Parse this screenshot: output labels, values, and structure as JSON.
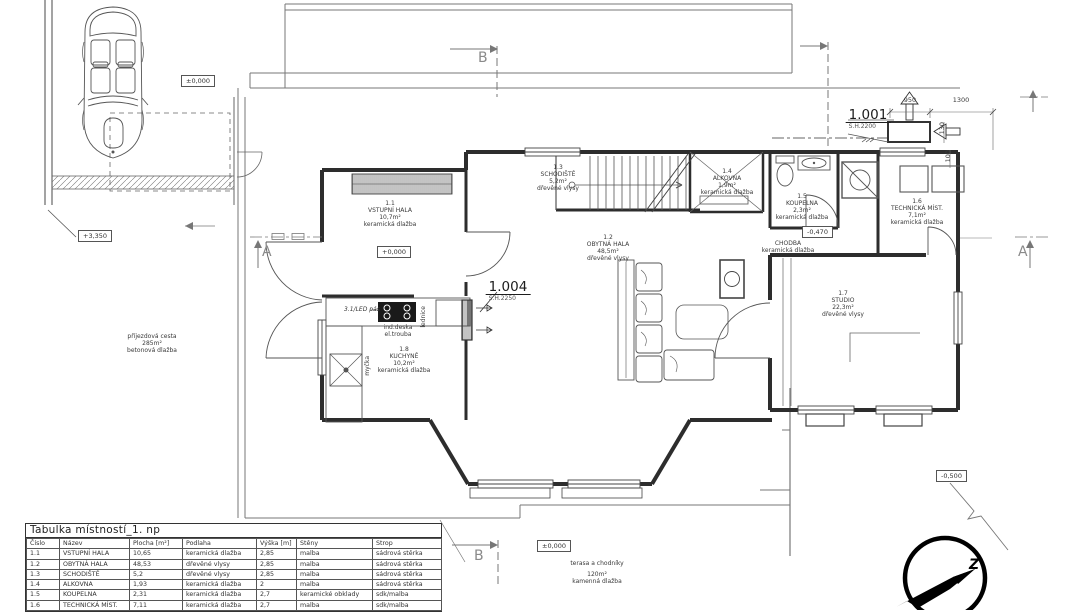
{
  "plan": {
    "levels": {
      "garage": "±0,000",
      "hall": "+0,000",
      "driveway_top": "+3,350",
      "chodba": "-0,470",
      "yard": "-0,500",
      "terrace": "±0,000"
    },
    "rooms": {
      "r11": {
        "num": "1.1",
        "name": "VSTUPNÍ HALA",
        "area": "10,7m²",
        "floor": "keramická dlažba"
      },
      "r12": {
        "num": "1.2",
        "name": "OBYTNÁ HALA",
        "area": "48,5m²",
        "floor": "dřevěné vlysy"
      },
      "r13": {
        "num": "1.3",
        "name": "SCHODIŠTĚ",
        "area": "5,2m²",
        "floor": "dřevěné vlysy"
      },
      "r14": {
        "num": "1.4",
        "name": "ALKOVNA",
        "area": "1,9m²",
        "floor": "keramická dlažba"
      },
      "r15": {
        "num": "1.5",
        "name": "KOUPELNA",
        "area": "2,3m²",
        "floor": "keramická dlažba"
      },
      "r16": {
        "num": "1.6",
        "name": "TECHNICKÁ MÍST.",
        "area": "7,1m²",
        "floor": "keramická dlažba"
      },
      "r17": {
        "num": "1.7",
        "name": "STUDIO",
        "area": "22,3m²",
        "floor": "dřevěné vlysy"
      },
      "r18": {
        "num": "1.8",
        "name": "KUCHYNĚ",
        "area": "10,2m²",
        "floor": "keramická dlažba"
      },
      "chodba": {
        "name": "CHODBA",
        "floor": "keramická dlažba"
      }
    },
    "openings": {
      "o1001": {
        "code": "1.001",
        "sill": "S.H.2200"
      },
      "o1004": {
        "code": "1.004",
        "sill": "S.H.2250"
      }
    },
    "site": {
      "driveway": [
        "příjezdová cesta",
        "285m²",
        "betonová dlažba"
      ],
      "terrace": [
        "terasa a chodníky",
        "120m²",
        "kamenná dlažba"
      ]
    },
    "kitchen": {
      "led": "3.1/LED pás",
      "cooktop": [
        "ind.deska",
        "el.trouba"
      ],
      "fridge": "lednice",
      "dishwasher": "myčka"
    },
    "dimensions": {
      "d1": "950",
      "d2": "1300",
      "d3": "130",
      "d4": "100"
    },
    "sections": {
      "a": "A",
      "b": "B"
    },
    "compass": {
      "north": "Z"
    }
  },
  "table": {
    "title": "Tabulka místností_1. np",
    "headers": [
      "Číslo",
      "Název",
      "Plocha [m²]",
      "Podlaha",
      "Výška [m]",
      "Stěny",
      "Strop"
    ],
    "rows": [
      [
        "1.1",
        "VSTUPNÍ HALA",
        "10,65",
        "keramická dlažba",
        "2,85",
        "malba",
        "sádrová stěrka"
      ],
      [
        "1.2",
        "OBYTNÁ HALA",
        "48,53",
        "dřevěné vlysy",
        "2,85",
        "malba",
        "sádrová stěrka"
      ],
      [
        "1.3",
        "SCHODIŠTĚ",
        "5,2",
        "dřevěné vlysy",
        "2,85",
        "malba",
        "sádrová stěrka"
      ],
      [
        "1.4",
        "ALKOVNA",
        "1,93",
        "keramická dlažba",
        "2",
        "malba",
        "sádrová stěrka"
      ],
      [
        "1.5",
        "KOUPELNA",
        "2,31",
        "keramická dlažba",
        "2,7",
        "keramické obklady",
        "sdk/malba"
      ],
      [
        "1.6",
        "TECHNICKÁ MÍST.",
        "7,11",
        "keramická dlažba",
        "2,7",
        "malba",
        "sdk/malba"
      ]
    ]
  }
}
